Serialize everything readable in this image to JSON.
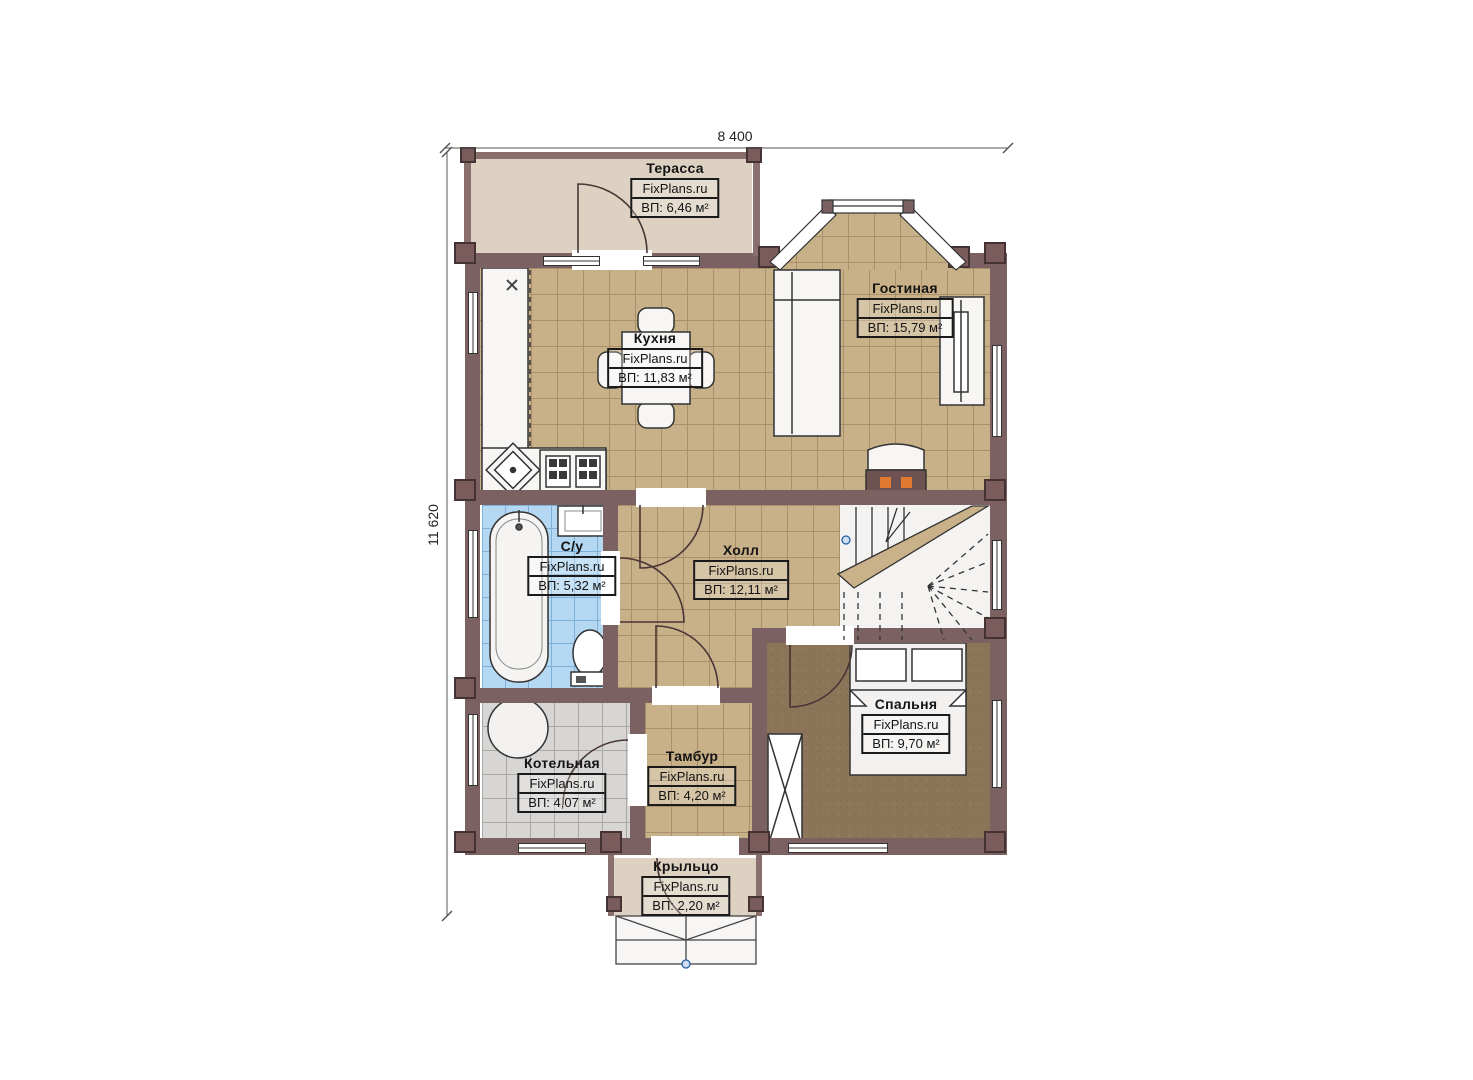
{
  "plan": {
    "type": "floor-plan",
    "brand": "FixPlans.ru",
    "dimensions": {
      "width_label": "8 400",
      "height_label": "11 620"
    }
  },
  "rooms": [
    {
      "id": "terrace",
      "name": "Терасса",
      "brand": "FixPlans.ru",
      "area": "ВП: 6,46 м²"
    },
    {
      "id": "living",
      "name": "Гостиная",
      "brand": "FixPlans.ru",
      "area": "ВП: 15,79 м²"
    },
    {
      "id": "kitchen",
      "name": "Кухня",
      "brand": "FixPlans.ru",
      "area": "ВП: 11,83 м²"
    },
    {
      "id": "bathroom",
      "name": "С/у",
      "brand": "FixPlans.ru",
      "area": "ВП: 5,32 м²"
    },
    {
      "id": "hall",
      "name": "Холл",
      "brand": "FixPlans.ru",
      "area": "ВП: 12,11 м²"
    },
    {
      "id": "bedroom",
      "name": "Спальня",
      "brand": "FixPlans.ru",
      "area": "ВП: 9,70 м²"
    },
    {
      "id": "boiler",
      "name": "Котельная",
      "brand": "FixPlans.ru",
      "area": "ВП: 4,07 м²"
    },
    {
      "id": "tambour",
      "name": "Тамбур",
      "brand": "FixPlans.ru",
      "area": "ВП: 4,20 м²"
    },
    {
      "id": "porch",
      "name": "Крыльцо",
      "brand": "FixPlans.ru",
      "area": "ВП: 2,20 м²"
    }
  ],
  "colors": {
    "wall": "#7b6162",
    "floor_tile_tan": "#c8b088",
    "floor_tile_blue": "#b5d8f2",
    "floor_tile_gray": "#d7d6d4",
    "floor_bedroom_brown": "#8c7458",
    "floor_terrace_beige": "#ddd1c1",
    "fireplace_orange": "#e07830"
  }
}
